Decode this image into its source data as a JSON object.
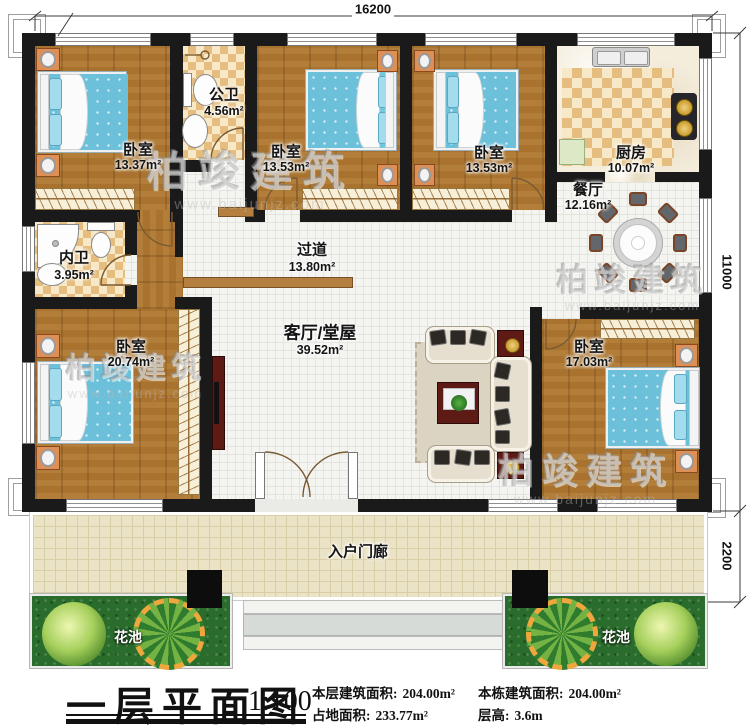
{
  "watermark": {
    "name": "柏竣建筑",
    "url": "www.baijunjz.com"
  },
  "dimensions": {
    "top": "16200",
    "side": "11000",
    "porch": "2200"
  },
  "rooms": {
    "bedroom1": {
      "name": "卧室",
      "area": "13.37m²"
    },
    "public_bath": {
      "name": "公卫",
      "area": "4.56m²"
    },
    "bedroom2": {
      "name": "卧室",
      "area": "13.53m²"
    },
    "bedroom3": {
      "name": "卧室",
      "area": "13.53m²"
    },
    "kitchen": {
      "name": "厨房",
      "area": "10.07m²"
    },
    "dining": {
      "name": "餐厅",
      "area": "12.16m²"
    },
    "corridor": {
      "name": "过道",
      "area": "13.80m²"
    },
    "private_bath": {
      "name": "内卫",
      "area": "3.95m²"
    },
    "bedroom4": {
      "name": "卧室",
      "area": "20.74m²"
    },
    "living": {
      "name": "客厅/堂屋",
      "area": "39.52m²"
    },
    "bedroom5": {
      "name": "卧室",
      "area": "17.03m²"
    },
    "porch": {
      "name": "入户门廊"
    },
    "flower_left": {
      "name": "花池"
    },
    "flower_right": {
      "name": "花池"
    }
  },
  "title_block": {
    "title": "一层平面图",
    "scale": "1:100",
    "stats": [
      {
        "label": "本层建筑面积:",
        "value": "204.00m²"
      },
      {
        "label": "占地面积:",
        "value": "233.77m²"
      },
      {
        "label": "本栋建筑面积:",
        "value": "204.00m²"
      },
      {
        "label": "层高:",
        "value": "3.6m"
      }
    ]
  },
  "colors": {
    "wall": "#1a1a1a",
    "wood_floor": "#a9732f",
    "tile_floor": "#f4f4f1",
    "checker_tile": "#e5bd7e",
    "bed_blue": "#6cc0da",
    "nightstand_orange": "#dd8f55",
    "accent_darkred": "#5e1a15",
    "garden_green": "#2a6c2c",
    "porch_cream": "#ebe3c6"
  }
}
